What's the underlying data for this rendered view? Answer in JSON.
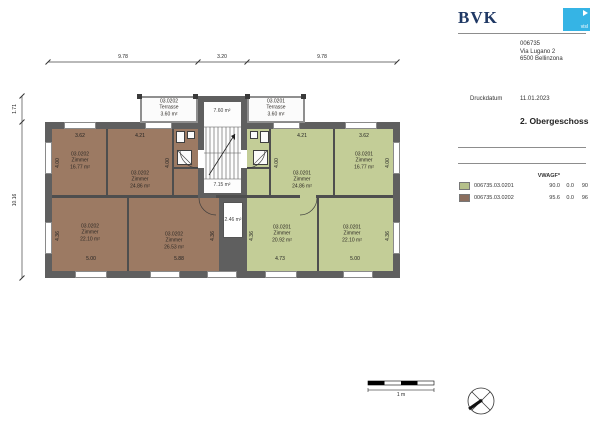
{
  "header": {
    "logo_text": "BVK",
    "logo_badge_text": "visl",
    "project_number": "006735",
    "address_line1": "Via Lugano 2",
    "address_line2": "6500 Bellinzona",
    "print_date_label": "Druckdatum",
    "print_date": "11.01.2023",
    "floor_title": "2. Obergeschoss"
  },
  "legend": {
    "column_header": "VWAGF*",
    "rows": [
      {
        "id": "006735.03.0201",
        "v1": "90.0",
        "v2": "0.0",
        "v3": "90",
        "color": "#b5c08a"
      },
      {
        "id": "006735.03.0202",
        "v1": "95.6",
        "v2": "0.0",
        "v3": "96",
        "color": "#8b6e5e"
      }
    ]
  },
  "plan": {
    "dims": {
      "top": [
        "9.78",
        "3.20",
        "9.78"
      ],
      "left": [
        "1.71",
        "10.16"
      ],
      "h": [
        "3.62",
        "4.21",
        "4.21",
        "3.62",
        "5.00",
        "5.88",
        "4.73",
        "5.00"
      ],
      "v": [
        "4.00",
        "4.00",
        "4.00",
        "4.00",
        "4.36",
        "4.36",
        "4.36",
        "4.36"
      ]
    },
    "rooms": [
      {
        "unit": "03.0202",
        "name": "Zimmer",
        "area": "16.77 m²"
      },
      {
        "unit": "03.0202",
        "name": "Zimmer",
        "area": "24.86 m²"
      },
      {
        "unit": "03.0202",
        "name": "Zimmer",
        "area": "22.10 m²"
      },
      {
        "unit": "03.0202",
        "name": "Zimmer",
        "area": "26.53 m²"
      },
      {
        "unit": "03.0202",
        "name": "Terrasse",
        "area": "3.60 m²"
      },
      {
        "unit": "03.0201",
        "name": "Zimmer",
        "area": "24.86 m²"
      },
      {
        "unit": "03.0201",
        "name": "Zimmer",
        "area": "16.77 m²"
      },
      {
        "unit": "03.0201",
        "name": "Zimmer",
        "area": "20.92 m²"
      },
      {
        "unit": "03.0201",
        "name": "Zimmer",
        "area": "22.10 m²"
      },
      {
        "unit": "03.0201",
        "name": "Terrasse",
        "area": "3.60 m²"
      }
    ],
    "core": {
      "top": "7.60 m²",
      "hall": "7.15 m²",
      "shaft": "2.46 m²"
    }
  },
  "scale": {
    "label": "1 m"
  },
  "colors": {
    "unit_0201_fill": "#c3cd97",
    "unit_0202_fill": "#9c7a63",
    "wall_gray": "#5f5f5f",
    "accent_cyan": "#35b4e5",
    "logo_navy": "#1f3864"
  }
}
